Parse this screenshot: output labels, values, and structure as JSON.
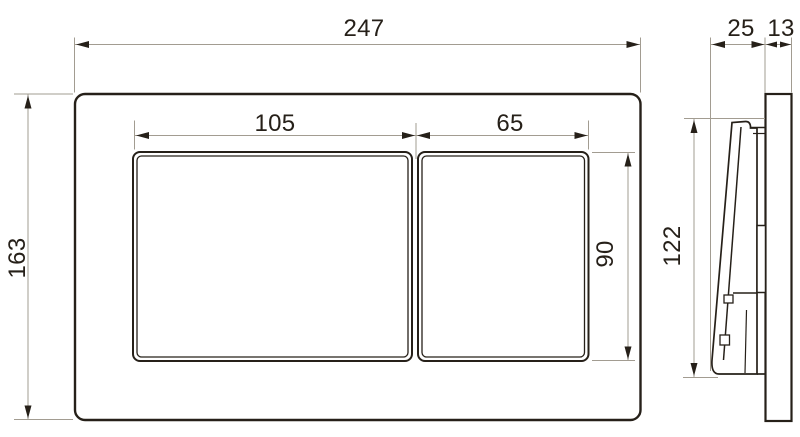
{
  "drawing": {
    "kind": "technical-dimension-drawing",
    "background": "#ffffff",
    "line_color": "#262019",
    "construction_line_color": "#a29c91",
    "front_view": {
      "name": "flush-plate-front-view",
      "dims": {
        "plate_width": "247",
        "plate_height": "163",
        "large_button_width": "105",
        "small_button_width": "65",
        "button_height": "90"
      }
    },
    "side_view": {
      "name": "flush-plate-side-view",
      "dims": {
        "button_depth": "25",
        "plate_thickness": "13",
        "panel_height": "122"
      }
    }
  }
}
